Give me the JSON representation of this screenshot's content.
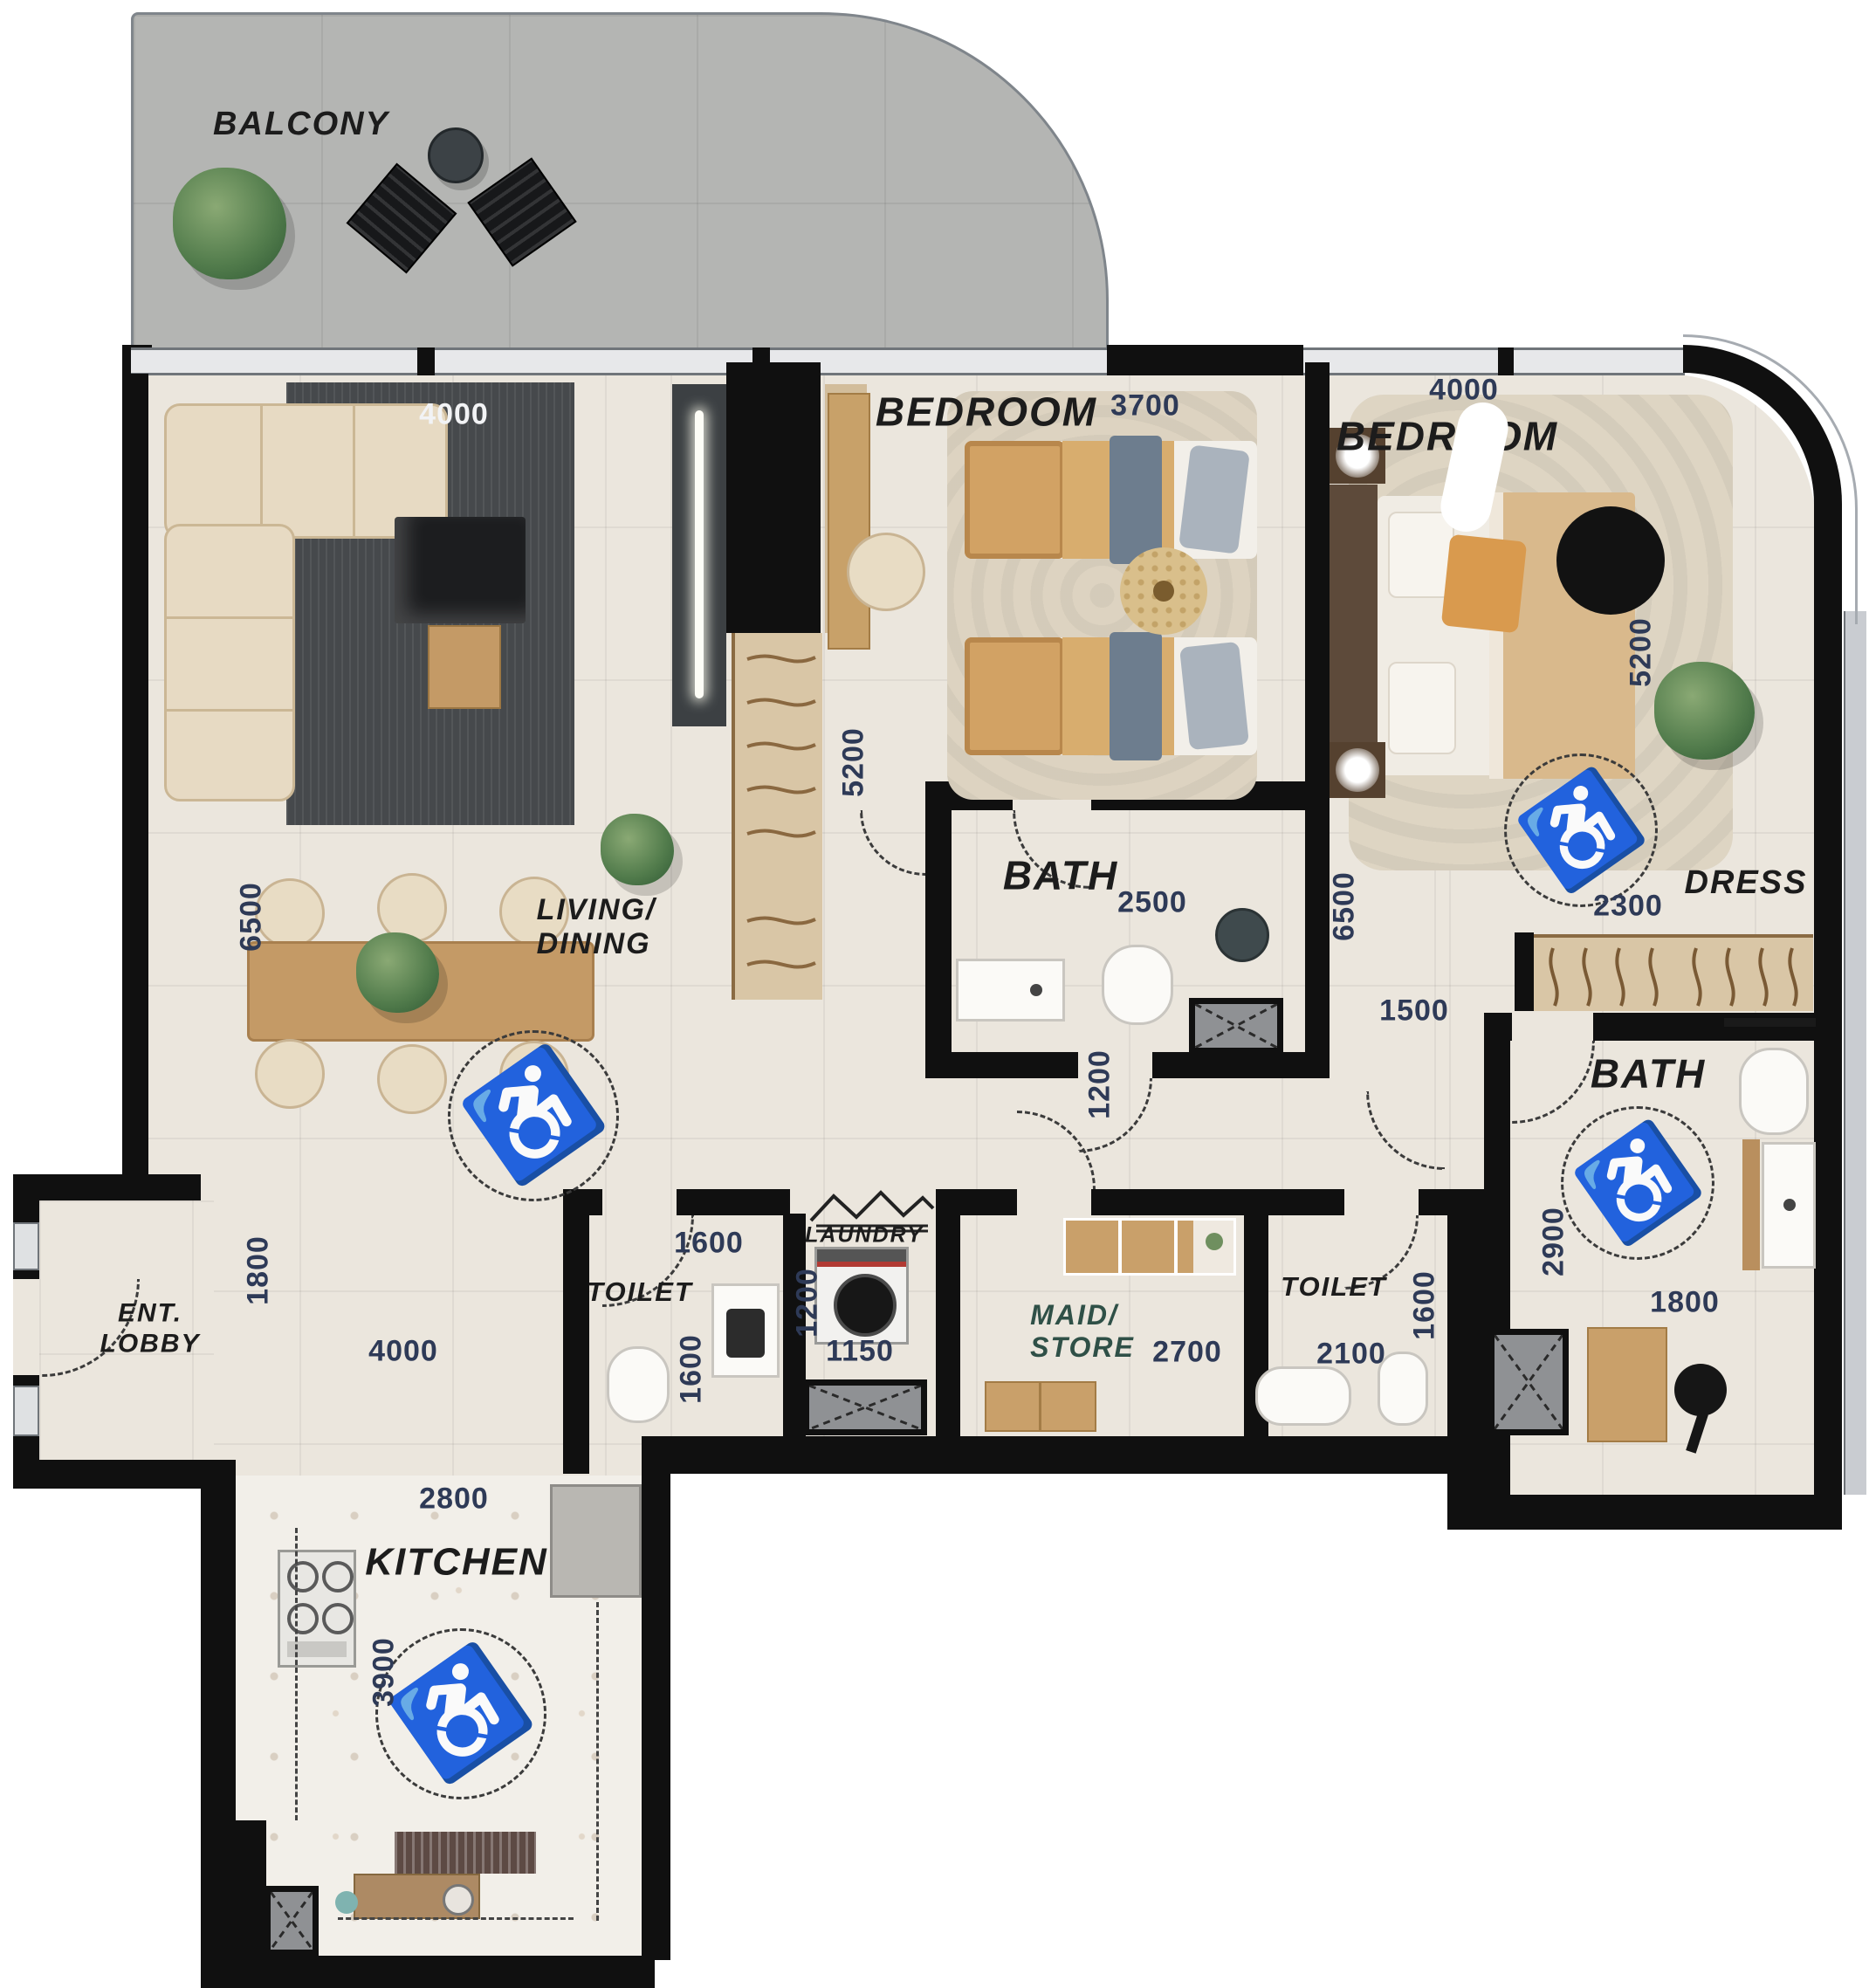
{
  "title": "Apartment floor plan",
  "rooms": {
    "balcony": "BALCONY",
    "living_dining": "LIVING/\nDINING",
    "bedroom1": "BEDROOM",
    "bedroom2": "BEDROOM",
    "bath1": "BATH",
    "bath2": "BATH",
    "toilet1": "TOILET",
    "toilet2": "TOILET",
    "laundry": "LAUNDRY",
    "maid_store": "MAID/\nSTORE",
    "dress": "DRESS",
    "ent_lobby": "ENT.\nLOBBY",
    "kitchen": "KITCHEN"
  },
  "dimensions": {
    "living_rug": "4000",
    "living_height": "6500",
    "lobby_height": "1800",
    "lobby_width": "4000",
    "kitchen_top": "2800",
    "kitchen_height": "3900",
    "wardrobe_height": "5200",
    "bedroom1_width": "3700",
    "bath1_width": "2500",
    "bath1_right_height": "6500",
    "corridor_mid": "1200",
    "corridor_right": "1500",
    "toilet1_width": "1600",
    "toilet1_height": "1600",
    "laundry_height": "1200",
    "laundry_width": "1150",
    "maid_width": "2700",
    "toilet2_width": "2100",
    "toilet2_height": "1600",
    "bedroom2_top": "4000",
    "bedroom2_right": "5200",
    "bedroom2_bottom": "2300",
    "bath2_height": "2900",
    "bath2_width": "1800"
  },
  "icons": {
    "wheelchair": "♿"
  },
  "colors": {
    "wall": "#101010",
    "floor": "#ebe6dd",
    "balcony-floor": "#b4b5b3",
    "dim": "#2e3a57",
    "label": "#1c1c1c",
    "maid-label": "#2f5047",
    "rug": "#46494c",
    "wood": "#c49a66",
    "cream": "#e7dac3",
    "wardrobe": "#d9c6a6",
    "accent-dark": "#3c4043"
  }
}
